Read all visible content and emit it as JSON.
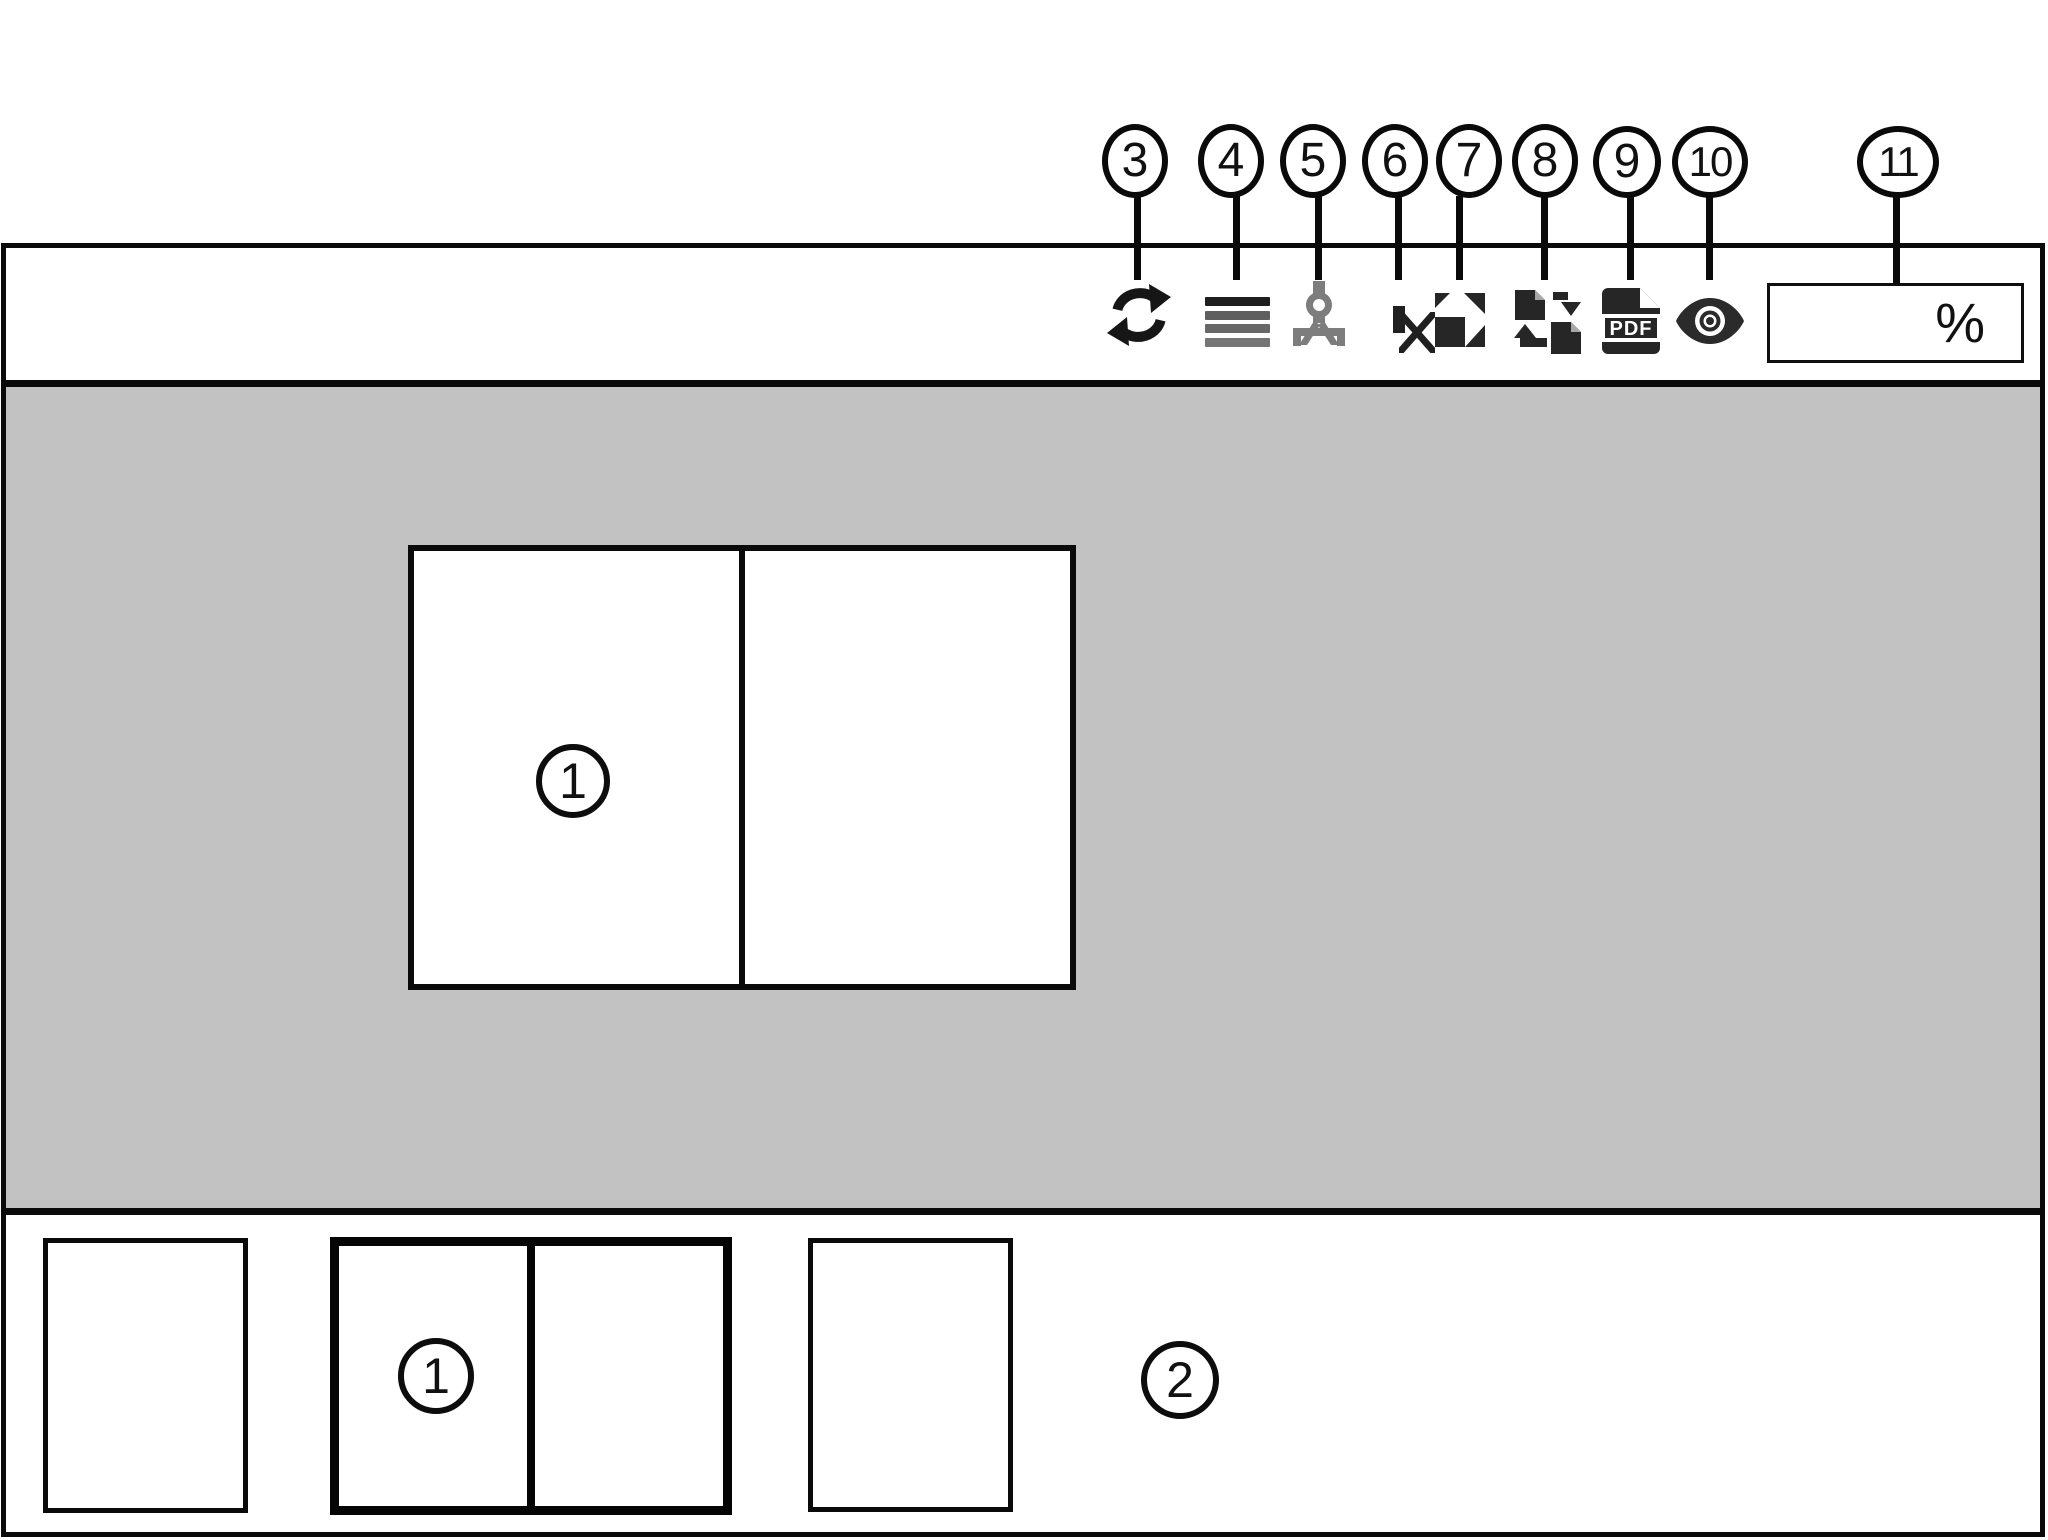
{
  "figure": {
    "description": "Print preview window diagram with numbered callouts",
    "content_labels": {
      "preview_spread": "1",
      "selected_thumbnail": "1",
      "thumbnail_area": "2"
    }
  },
  "callouts": [
    {
      "num": "3",
      "target": "refresh-button"
    },
    {
      "num": "4",
      "target": "line-weight-button"
    },
    {
      "num": "5",
      "target": "measure-tool-button"
    },
    {
      "num": "6",
      "target": "delete-page-button"
    },
    {
      "num": "7",
      "target": "fit-to-page-button"
    },
    {
      "num": "8",
      "target": "page-order-button"
    },
    {
      "num": "9",
      "target": "save-as-pdf-button"
    },
    {
      "num": "10",
      "target": "view-mode-button"
    },
    {
      "num": "11",
      "target": "zoom-percent-field"
    }
  ],
  "toolbar": {
    "pdf_badge": "PDF",
    "zoom_field": {
      "value": "",
      "unit": "%"
    }
  },
  "colors": {
    "canvas_gray": "#c2c2c2",
    "line_black": "#0a0a0a",
    "icon_dark": "#262626",
    "compass_gray": "#7d7d7d"
  }
}
